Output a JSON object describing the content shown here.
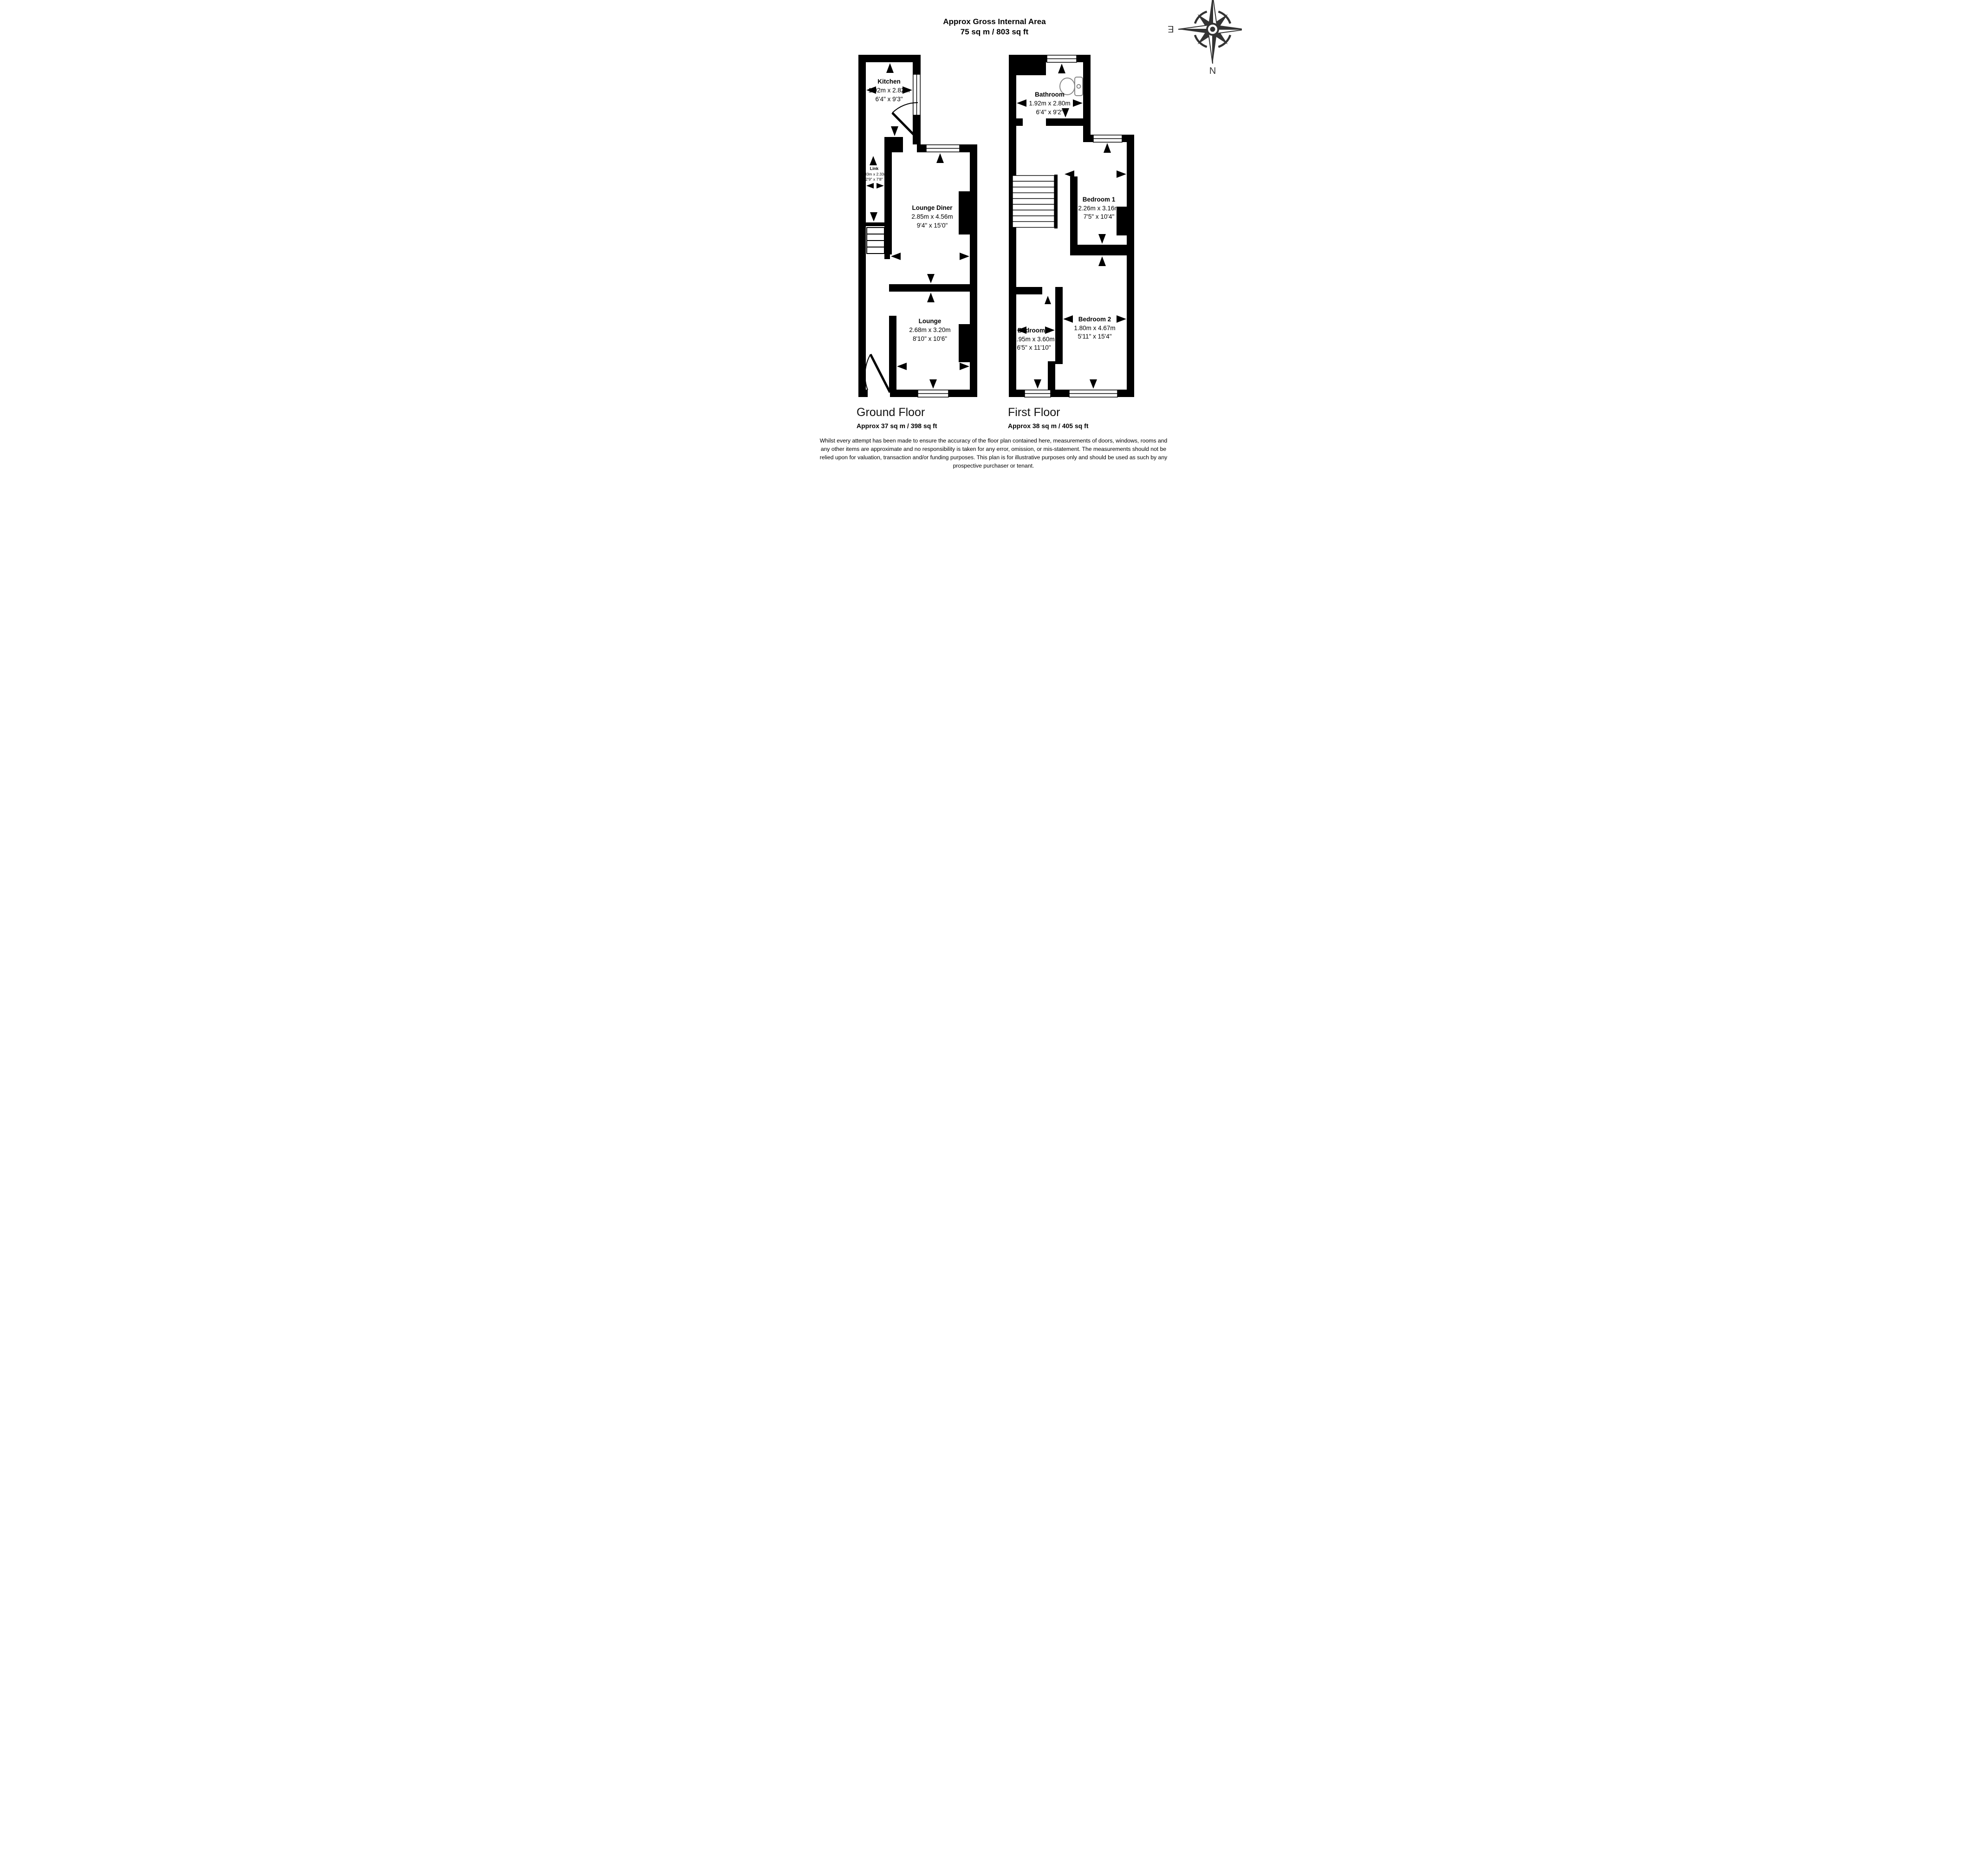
{
  "title": {
    "line1": "Approx Gross Internal Area",
    "line2": "75 sq m / 803 sq ft"
  },
  "compass": {
    "n": "N",
    "e": "E",
    "s": "S",
    "w": "W"
  },
  "ground_floor": {
    "name": "Ground Floor",
    "area": "Approx 37 sq m / 398 sq ft",
    "rooms": {
      "kitchen": {
        "name": "Kitchen",
        "metric": "1.92m x 2.82m",
        "imperial": "6'4\" x 9'3\""
      },
      "link": {
        "name": "Link",
        "metric": "0.83m x 2.33m",
        "imperial": "2'9\" x 7'8\""
      },
      "lounge_diner": {
        "name": "Lounge Diner",
        "metric": "2.85m x 4.56m",
        "imperial": "9'4\" x 15'0\""
      },
      "lounge": {
        "name": "Lounge",
        "metric": "2.68m x 3.20m",
        "imperial": "8'10\" x 10'6\""
      }
    }
  },
  "first_floor": {
    "name": "First Floor",
    "area": "Approx 38 sq m / 405 sq ft",
    "rooms": {
      "bathroom": {
        "name": "Bathroom",
        "metric": "1.92m x 2.80m",
        "imperial": "6'4\" x 9'2\""
      },
      "bedroom1": {
        "name": "Bedroom 1",
        "metric": "2.26m x 3.16m",
        "imperial": "7'5\" x 10'4\""
      },
      "bedroom2": {
        "name": "Bedroom 2",
        "metric": "1.80m x 4.67m",
        "imperial": "5'11\" x 15'4\""
      },
      "bedroom3": {
        "name": "Bedroom 3",
        "metric": "1.95m x 3.60m",
        "imperial": "6'5\" x 11'10\""
      }
    }
  },
  "disclaimer": {
    "line1": "Whilst every attempt has been made to ensure the accuracy of the floor plan contained here, measurements of doors, windows, rooms and",
    "line2": "any other items are approximate and no responsibility is taken for any error, omission, or mis-statement. The measurements should not be",
    "line3": "relied upon for valuation, transaction and/or funding purposes. This plan is for illustrative purposes only and should be used as such by any",
    "line4": "prospective purchaser or tenant."
  }
}
